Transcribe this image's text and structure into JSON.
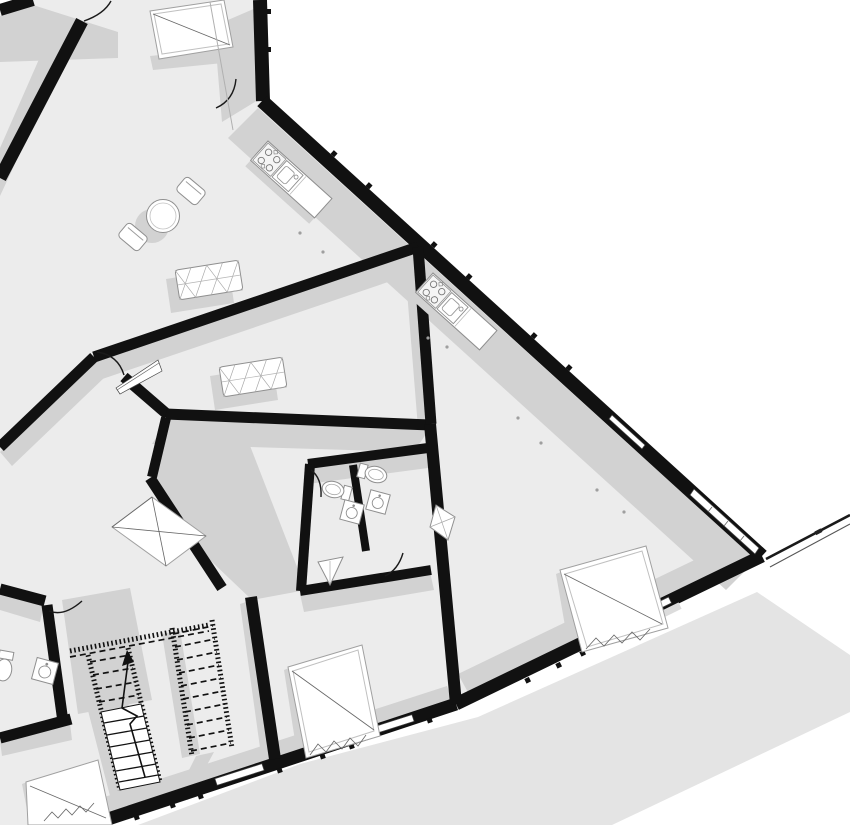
{
  "document": {
    "type": "architectural floor plan",
    "view": "rotated top-down plan (BIM style render)",
    "visible_text": ""
  },
  "colors": {
    "background": "#ffffff",
    "floor": "#ececec",
    "shadow": "#d2d2d2",
    "exterior_shadow": "#e4e4e4",
    "wall": "#111111",
    "furniture_fill": "#ffffff",
    "furniture_stroke": "#8f8f8f",
    "frame_stroke": "#a0a0a0",
    "detail": "#666666"
  },
  "inventory": {
    "kitchen_counters": 2,
    "cooktops": 2,
    "kitchen_sinks": 2,
    "toilets": 3,
    "wash_basins": 4,
    "corner_shelves": 2,
    "sofas": 2,
    "round_tables": 1,
    "chairs": 2,
    "stair_flights": 2,
    "skylights": 5,
    "door_swings": 6,
    "balcony_railings": 1
  }
}
